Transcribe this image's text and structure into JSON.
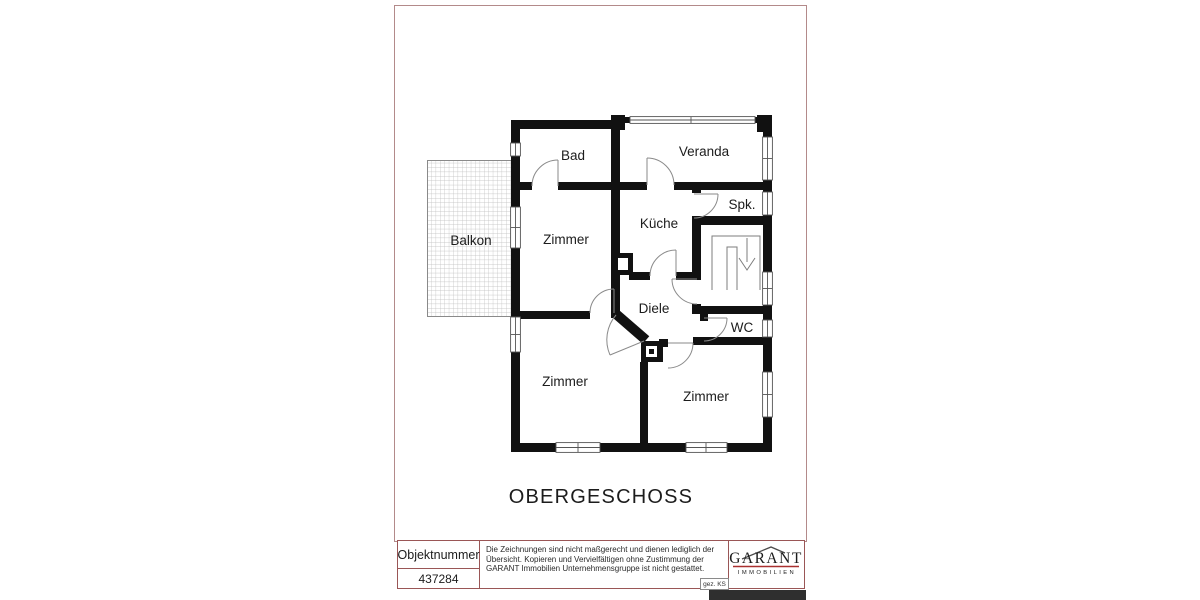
{
  "floor_plan": {
    "title": "OBERGESCHOSS",
    "rooms": [
      {
        "id": "bad",
        "label": "Bad"
      },
      {
        "id": "veranda",
        "label": "Veranda"
      },
      {
        "id": "spk",
        "label": "Spk."
      },
      {
        "id": "kueche",
        "label": "Küche"
      },
      {
        "id": "zimmer_upper_left",
        "label": "Zimmer"
      },
      {
        "id": "balkon",
        "label": "Balkon"
      },
      {
        "id": "diele",
        "label": "Diele"
      },
      {
        "id": "wc",
        "label": "WC"
      },
      {
        "id": "zimmer_lower_left",
        "label": "Zimmer"
      },
      {
        "id": "zimmer_lower_right",
        "label": "Zimmer"
      }
    ]
  },
  "title_block": {
    "object_number_label": "Objektnummer",
    "object_number_value": "437284",
    "disclaimer": "Die Zeichnungen sind nicht maßgerecht und dienen lediglich der Übersicht. Kopieren und Vervielfältigen ohne Zustimmung der GARANT Immobilien Unternehmensgruppe ist nicht gestattet.",
    "drawn_by": "gez. KS",
    "logo": {
      "name": "GARANT",
      "subtitle": "IMMOBILIEN"
    }
  },
  "colors": {
    "sheet_border": "#b38a8a",
    "title_block_border": "#9a5656",
    "wall": "#111111",
    "logo_red": "#a93030"
  }
}
